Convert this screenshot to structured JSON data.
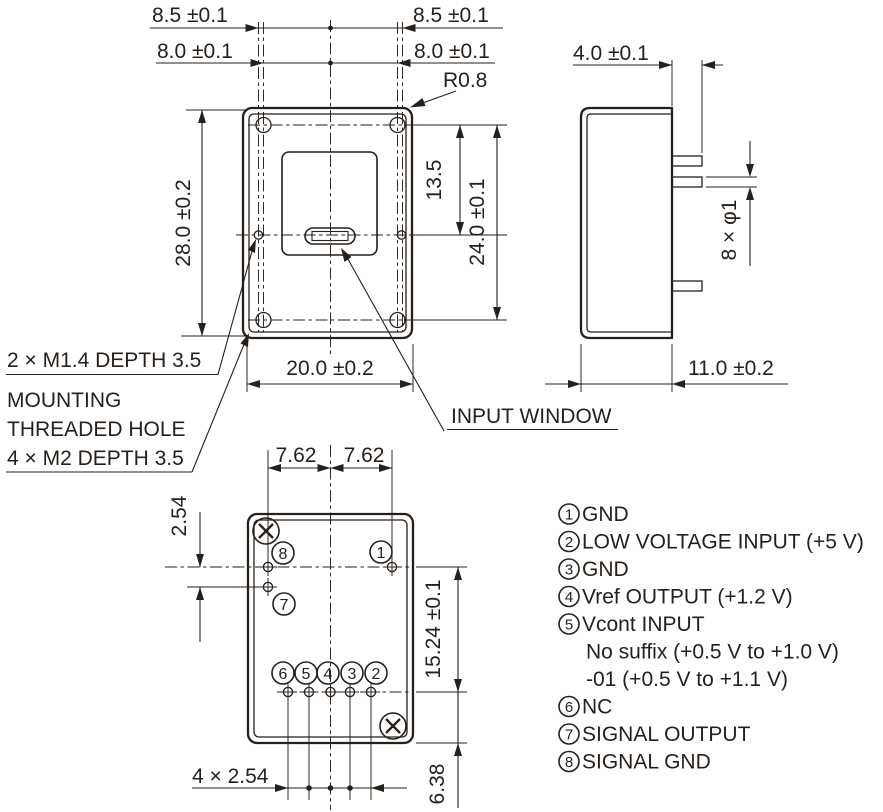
{
  "drawing": {
    "front_view": {
      "dim_85_left": "8.5 ±0.1",
      "dim_85_right": "8.5 ±0.1",
      "dim_80_left": "8.0 ±0.1",
      "dim_80_right": "8.0 ±0.1",
      "corner_radius": "R0.8",
      "dim_height": "28.0 ±0.2",
      "dim_window_offset": "13.5",
      "dim_hole_span": "24.0 ±0.1",
      "dim_width": "20.0 ±0.2",
      "callout_m14": "2 × M1.4 DEPTH 3.5",
      "callout_mounting_line1": "MOUNTING",
      "callout_mounting_line2": "THREADED HOLE",
      "callout_mounting_line3": "4 × M2 DEPTH 3.5",
      "callout_input_window": "INPUT WINDOW"
    },
    "side_view": {
      "dim_pin_length": "4.0 ±0.1",
      "dim_pin_dia": "8 × φ1",
      "dim_depth": "11.0 ±0.2"
    },
    "bottom_view": {
      "dim_pitch_left": "7.62",
      "dim_pitch_right": "7.62",
      "dim_row_gap": "2.54",
      "dim_row_span": "15.24 ±0.1",
      "dim_bottom_offset": "6.38",
      "dim_pin_pitch": "4 × 2.54",
      "pin_numbers": {
        "p1": "1",
        "p2": "2",
        "p3": "3",
        "p4": "4",
        "p5": "5",
        "p6": "6",
        "p7": "7",
        "p8": "8"
      }
    },
    "pin_list": {
      "items": [
        {
          "num": "1",
          "label": "GND"
        },
        {
          "num": "2",
          "label": "LOW VOLTAGE INPUT (+5 V)"
        },
        {
          "num": "3",
          "label": "GND"
        },
        {
          "num": "4",
          "label": "Vref OUTPUT (+1.2 V)"
        },
        {
          "num": "5",
          "label": "Vcont INPUT"
        },
        {
          "num": "",
          "label": "No suffix (+0.5 V to +1.0 V)"
        },
        {
          "num": "",
          "label": "-01 (+0.5 V to +1.1 V)"
        },
        {
          "num": "6",
          "label": "NC"
        },
        {
          "num": "7",
          "label": "SIGNAL OUTPUT"
        },
        {
          "num": "8",
          "label": "SIGNAL GND"
        }
      ]
    }
  }
}
